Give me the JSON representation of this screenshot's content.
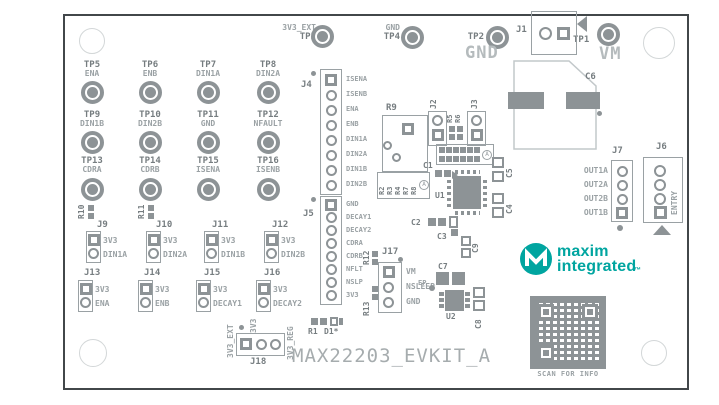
{
  "board": {
    "title": "MAX22203_EVKIT_A"
  },
  "big": {
    "gnd": "GND",
    "vm": "VM"
  },
  "tp_top": [
    {
      "sig": "3V3_EXT",
      "ref": "TP3"
    },
    {
      "sig": "GND",
      "ref": "TP4"
    },
    {
      "sig": "",
      "ref": "TP2"
    },
    {
      "sig": "",
      "ref": "TP1"
    }
  ],
  "tp_grid": [
    {
      "ref": "TP5",
      "sig": "ENA"
    },
    {
      "ref": "TP6",
      "sig": "ENB"
    },
    {
      "ref": "TP7",
      "sig": "DIN1A"
    },
    {
      "ref": "TP8",
      "sig": "DIN2A"
    },
    {
      "ref": "TP9",
      "sig": "DIN1B"
    },
    {
      "ref": "TP10",
      "sig": "DIN2B"
    },
    {
      "ref": "TP11",
      "sig": "GND"
    },
    {
      "ref": "TP12",
      "sig": "NFAULT"
    },
    {
      "ref": "TP13",
      "sig": "CDRA"
    },
    {
      "ref": "TP14",
      "sig": "CDRB"
    },
    {
      "ref": "TP15",
      "sig": "ISENA"
    },
    {
      "ref": "TP16",
      "sig": "ISENB"
    }
  ],
  "headers": {
    "j1": {
      "ref": "J1"
    },
    "j2": {
      "ref": "J2"
    },
    "j3": {
      "ref": "J3"
    },
    "j4": {
      "ref": "J4",
      "pins": [
        "ISENA",
        "ISENB",
        "ENA",
        "ENB",
        "DIN1A",
        "DIN2A",
        "DIN1B",
        "DIN2B"
      ]
    },
    "j5": {
      "ref": "J5",
      "pins": [
        "GND",
        "DECAY1",
        "DECAY2",
        "CDRA",
        "CDRB",
        "NFLT",
        "NSLP",
        "3V3"
      ]
    },
    "j6": {
      "ref": "J6",
      "vlabel": "ENTRY"
    },
    "j7": {
      "ref": "J7",
      "pins": [
        "OUT1A",
        "OUT2A",
        "OUT2B",
        "OUT1B"
      ]
    },
    "j17": {
      "ref": "J17",
      "pins": [
        "VM",
        "NSLEEP",
        "GND"
      ]
    },
    "j18": {
      "ref": "J18",
      "l1": "3V3_EXT",
      "l2": "3V3",
      "l3": "3V3_REG"
    }
  },
  "jumpers": {
    "row1": [
      {
        "ref": "J9",
        "a": "3V3",
        "b": "DIN1A"
      },
      {
        "ref": "J10",
        "a": "3V3",
        "b": "DIN2A"
      },
      {
        "ref": "J11",
        "a": "3V3",
        "b": "DIN1B"
      },
      {
        "ref": "J12",
        "a": "3V3",
        "b": "DIN2B"
      }
    ],
    "row2": [
      {
        "ref": "J13",
        "a": "3V3",
        "b": "ENA"
      },
      {
        "ref": "J14",
        "a": "3V3",
        "b": "ENB"
      },
      {
        "ref": "J15",
        "a": "3V3",
        "b": "DECAY1"
      },
      {
        "ref": "J16",
        "a": "3V3",
        "b": "DECAY2"
      }
    ]
  },
  "resistors": {
    "r1": "R1",
    "d1": "D1*",
    "r5": "R5",
    "r6": "R6",
    "r9": "R9",
    "r10": "R10",
    "r11": "R11",
    "r12": "R12",
    "r13": "R13"
  },
  "rgroup": {
    "r2": "R2",
    "r3": "R3",
    "r4": "R4",
    "r7": "R7",
    "r8": "R8",
    "mark": "A"
  },
  "capacitors": {
    "c1": "C1",
    "c2": "C2",
    "c3": "C3",
    "c4": "C4",
    "c5": "C5",
    "c6": "C6",
    "c7": "C7",
    "c8": "C8",
    "c9": "C9"
  },
  "ics": {
    "u1": "U1",
    "u2": "U2",
    "ep": "EP"
  },
  "marks": {
    "assembly": "A"
  },
  "logo": {
    "word1": "maxim",
    "word2": "integrated",
    "tm": "™"
  },
  "qr": {
    "caption": "SCAN FOR INFO"
  },
  "colors": {
    "teal": "#00a5a0",
    "silkscreen": "#8d9396",
    "board_border": "#42474a"
  }
}
